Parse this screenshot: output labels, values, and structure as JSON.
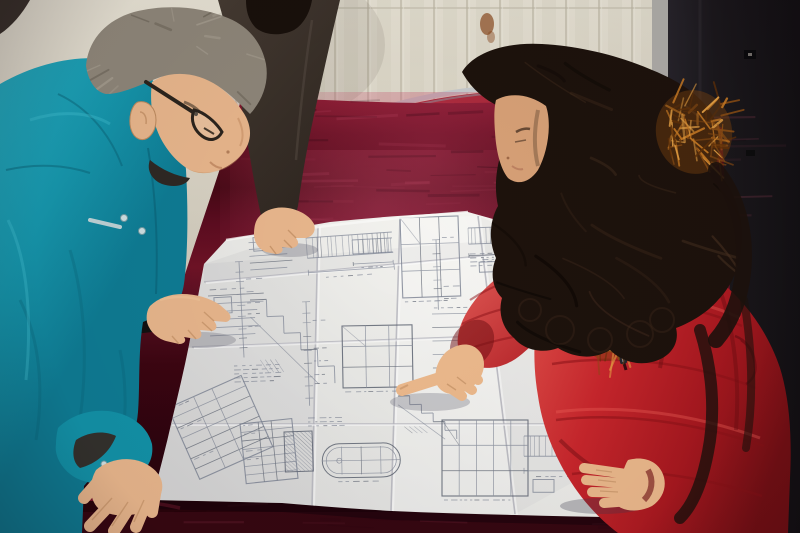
{
  "colors": {
    "wall": "#ddd8ca",
    "wallLine": "#bdb7a5",
    "wallHighlight": "#ece8dc",
    "wallShade": "#cdc7b6",
    "stain": "#8a4a1f",
    "door": "#1b181c",
    "doorFrame": "#aeaca8",
    "doorHardware": "#0a0a0c",
    "chairFrame": "#c6cacc",
    "chairFrameShade": "#85898c",
    "chairRed": "#a32530",
    "velvetStreakLight": "#cd5573",
    "velvetStreakDark": "#0f0008",
    "velvetCornerSheen": "#93203a",
    "paperInk": "#7d8494",
    "paperInkDark": "#59606e",
    "paperCrease": "#b7b7bf",
    "paperBright": "#fafaf7",
    "tealSeam": "#0a6377",
    "tealLight": "#49c6d6",
    "tealCuffInner": "#3a2018",
    "snap": "#cfe0e2",
    "snapRim": "#6f9aa2",
    "reflectiveStripe": "#d3dcdd",
    "manHair": "#8e8679",
    "manHairDark": "#6b6458",
    "manHairLight": "#a59d8f",
    "skin": "#e8b68c",
    "skinShadow": "#bd8a5e",
    "skinLight": "#f2c89c",
    "skinWoman": "#ecb98c",
    "skinWomanFace": "#d8a177",
    "darkJacket": "#453a32",
    "darkJacketShade": "#2f2721",
    "darkHair": "#18100b",
    "womanHair": "#1d120c",
    "womanHairLight": "#4a3322",
    "coatSeam": "#8c1218",
    "coatLight": "#ef5f58",
    "coatDeep": "#6e0d12",
    "zipper": "#3a0a0e",
    "zipperPull": "#26262b",
    "glasses": "#2b241d",
    "innerCollar": "#2e2824"
  },
  "wall_panel": {
    "slat_start": 236,
    "slat_end": 650,
    "slat_spacing": 33,
    "slat_top": 0,
    "slat_bottom": 138
  },
  "velvet_texture": {
    "top": {
      "count": 70,
      "x0": 238,
      "x1": 720,
      "y0": 100,
      "y1": 236,
      "len_min": 24,
      "len_max": 84
    },
    "bottom": {
      "count": 26,
      "x0": 140,
      "x1": 730,
      "y0": 505,
      "y1": 530,
      "len_min": 20,
      "len_max": 70
    }
  },
  "blueprint": {
    "clusters": [
      {
        "t": "stack",
        "x": 248,
        "y": 236,
        "w": 48,
        "h": 34,
        "rot": -4
      },
      {
        "t": "bars",
        "x": 306,
        "y": 238,
        "w": 86,
        "h": 58,
        "rot": -4
      },
      {
        "t": "grid",
        "x": 400,
        "y": 218,
        "w": 58,
        "h": 80,
        "rot": -2
      },
      {
        "t": "bars",
        "x": 468,
        "y": 228,
        "w": 66,
        "h": 46,
        "rot": -2
      },
      {
        "t": "bars",
        "x": 556,
        "y": 264,
        "w": 70,
        "h": 50,
        "rot": -2
      },
      {
        "t": "stack",
        "x": 208,
        "y": 296,
        "w": 58,
        "h": 40,
        "rot": -3
      },
      {
        "t": "steps",
        "x": 250,
        "y": 300,
        "w": 82,
        "h": 86,
        "rot": -2
      },
      {
        "t": "grid",
        "x": 342,
        "y": 326,
        "w": 70,
        "h": 62,
        "rot": -1
      },
      {
        "t": "stack",
        "x": 432,
        "y": 314,
        "w": 56,
        "h": 54,
        "rot": -1
      },
      {
        "t": "bars",
        "x": 540,
        "y": 336,
        "w": 64,
        "h": 54,
        "rot": 0
      },
      {
        "t": "table",
        "x": 168,
        "y": 408,
        "w": 80,
        "h": 78,
        "rot": -24
      },
      {
        "t": "table",
        "x": 240,
        "y": 424,
        "w": 52,
        "h": 60,
        "rot": -6
      },
      {
        "t": "oval",
        "x": 322,
        "y": 444,
        "w": 78,
        "h": 34,
        "rot": -1
      },
      {
        "t": "hatch",
        "x": 284,
        "y": 432,
        "w": 28,
        "h": 40,
        "rot": -2
      },
      {
        "t": "grid",
        "x": 442,
        "y": 420,
        "w": 86,
        "h": 76,
        "rot": 0
      },
      {
        "t": "bars",
        "x": 524,
        "y": 436,
        "w": 60,
        "h": 58,
        "rot": 0
      },
      {
        "t": "text",
        "x": 234,
        "y": 366,
        "w": 46,
        "h": 26,
        "rot": -2
      },
      {
        "t": "text",
        "x": 470,
        "y": 254,
        "w": 42,
        "h": 24,
        "rot": -2
      },
      {
        "t": "steps",
        "x": 398,
        "y": 396,
        "w": 58,
        "h": 44,
        "rot": -1
      },
      {
        "t": "vdim",
        "x": 232,
        "y": 262,
        "w": 14,
        "h": 96,
        "rot": -3
      },
      {
        "t": "vdim",
        "x": 300,
        "y": 302,
        "w": 12,
        "h": 104,
        "rot": -2
      },
      {
        "t": "bars",
        "x": 352,
        "y": 240,
        "w": 40,
        "h": 40,
        "rot": -3
      },
      {
        "t": "text",
        "x": 560,
        "y": 416,
        "w": 40,
        "h": 20,
        "rot": 0
      },
      {
        "t": "stack",
        "x": 606,
        "y": 300,
        "w": 46,
        "h": 58,
        "rot": 0
      },
      {
        "t": "vdim",
        "x": 430,
        "y": 240,
        "w": 12,
        "h": 70,
        "rot": -2
      },
      {
        "t": "text",
        "x": 308,
        "y": 418,
        "w": 36,
        "h": 18,
        "rot": -1
      }
    ],
    "creases": [
      {
        "x1": 318,
        "y1": 226,
        "x2": 312,
        "y2": 507
      },
      {
        "x1": 400,
        "y1": 218,
        "x2": 391,
        "y2": 511
      },
      {
        "x1": 478,
        "y1": 216,
        "x2": 515,
        "y2": 514
      },
      {
        "x1": 204,
        "y1": 282,
        "x2": 545,
        "y2": 250
      },
      {
        "x1": 192,
        "y1": 347,
        "x2": 648,
        "y2": 330
      },
      {
        "x1": 170,
        "y1": 424,
        "x2": 652,
        "y2": 424
      }
    ]
  },
  "fur_patches": [
    {
      "cx": 566,
      "cy": 262,
      "rx": 32,
      "ry": 44,
      "rot": 18,
      "count": 70,
      "layer": "under"
    },
    {
      "cx": 612,
      "cy": 330,
      "rx": 24,
      "ry": 32,
      "rot": 25,
      "count": 46,
      "layer": "under"
    },
    {
      "cx": 694,
      "cy": 132,
      "rx": 38,
      "ry": 42,
      "rot": -12,
      "count": 72,
      "layer": "over"
    }
  ],
  "hair_streaks": {
    "woman": {
      "light_count": 15,
      "dark_count": 9,
      "box": [
        478,
        56,
        250,
        270
      ]
    },
    "man": {
      "count": 20,
      "box": [
        92,
        14,
        168,
        96
      ],
      "crown": [
        176,
        32
      ]
    }
  }
}
